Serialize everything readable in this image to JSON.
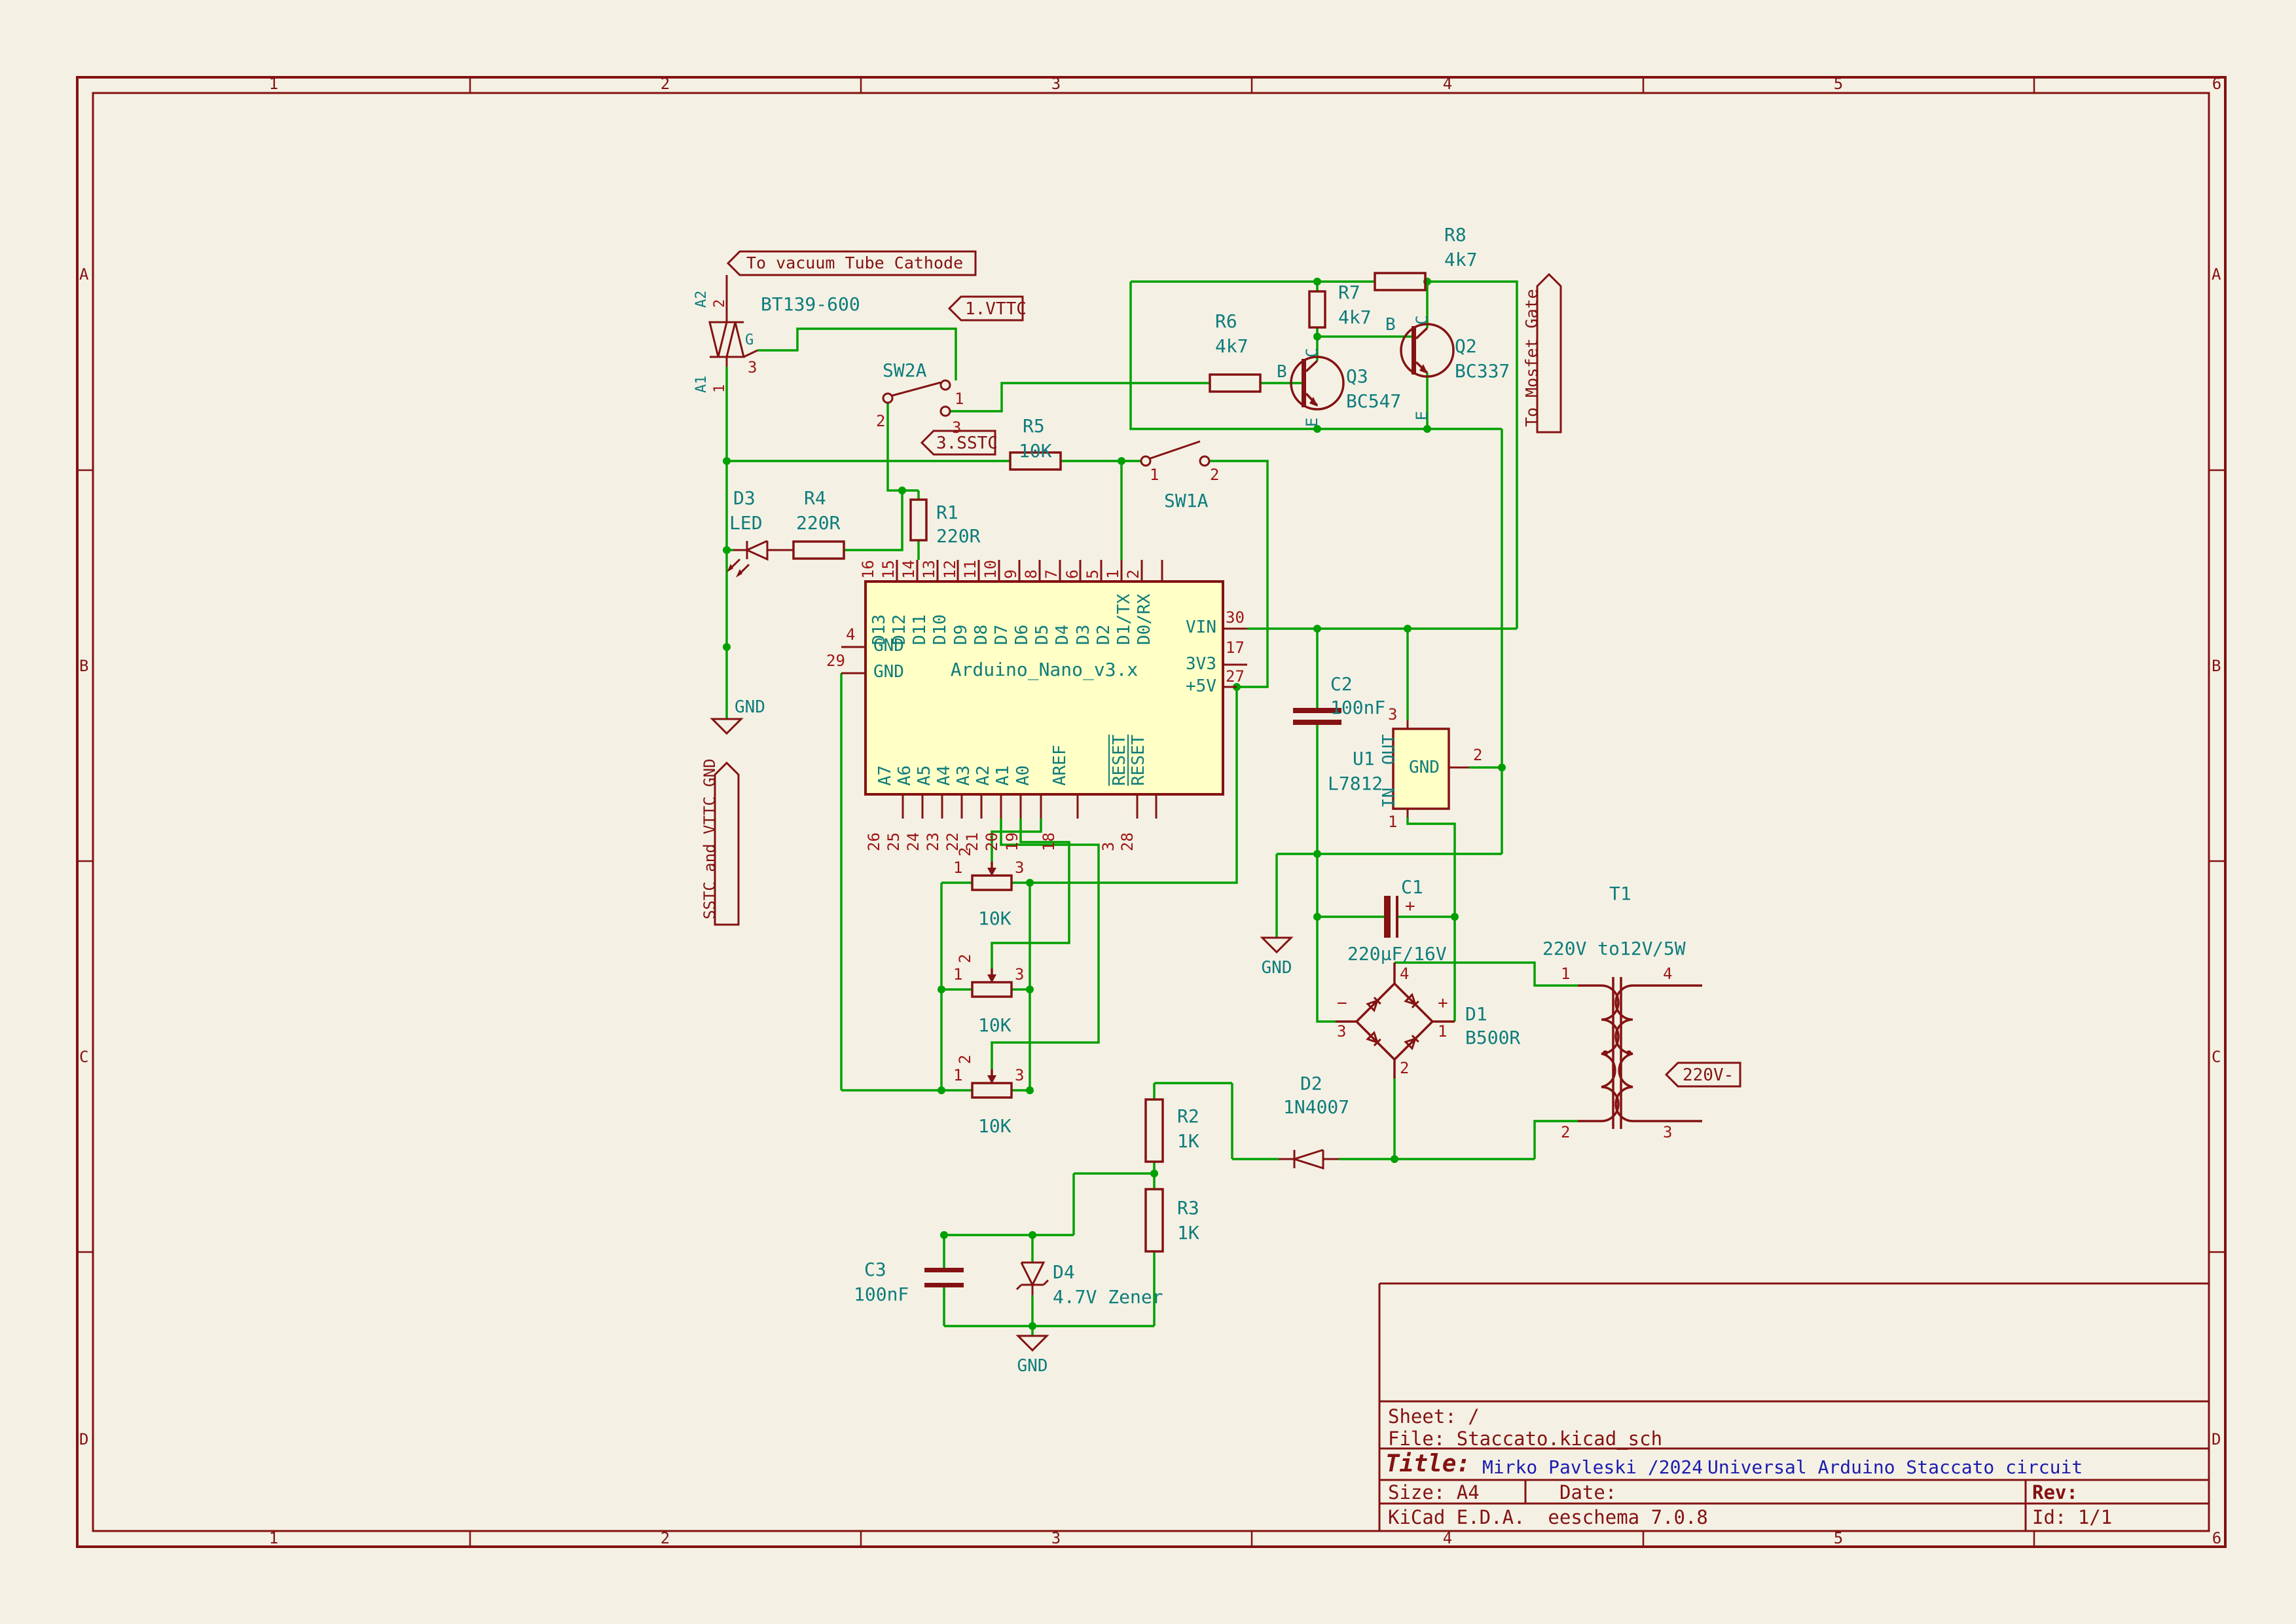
{
  "colors": {
    "background": "#F4F1E4",
    "wire_green": "#00A000",
    "component_red": "#841212",
    "field_teal": "#0E7C7C",
    "pin_number_red": "#9E1515",
    "title_blue": "#1C1CB0",
    "body_yellow": "#FFFFC6"
  },
  "sheet_zones": {
    "columns": [
      "1",
      "2",
      "3",
      "4",
      "5",
      "6"
    ],
    "rows": [
      "A",
      "B",
      "C",
      "D"
    ]
  },
  "title_block": {
    "sheet": "Sheet: /",
    "file": "File: Staccato.kicad_sch",
    "title_label": "Title:",
    "author": "Mirko Pavleski /2024",
    "title": "Universal Arduino Staccato circuit",
    "size": "Size: A4",
    "date": "Date:",
    "rev": "Rev:",
    "software": "KiCad E.D.A.  eeschema 7.0.8",
    "id": "Id: 1/1"
  },
  "hierarchical_labels": {
    "vttc_cathode": "To vacuum Tube Cathode",
    "vttc": "1.VTTC",
    "sstc": "3.SSTC",
    "sstc_vttc_gnd": "SSTC and VTTC GND",
    "mosfet_gate": "To Mosfet Gate",
    "v220": "220V-"
  },
  "power": {
    "gnd": "GND"
  },
  "components": {
    "triac": {
      "value": "BT139-600",
      "pin_a2": "A2",
      "pin_a1": "A1",
      "pin_g": "G",
      "n1": "1",
      "n2": "2",
      "n3": "3"
    },
    "d3": {
      "ref": "D3",
      "value": "LED"
    },
    "r4": {
      "ref": "R4",
      "value": "220R"
    },
    "r1": {
      "ref": "R1",
      "value": "220R"
    },
    "r5": {
      "ref": "R5",
      "value": "10K"
    },
    "sw2a": {
      "ref": "SW2A",
      "n1": "1",
      "n2": "2",
      "n3": "3"
    },
    "sw1a": {
      "ref": "SW1A",
      "n1": "1",
      "n2": "2"
    },
    "r6": {
      "ref": "R6",
      "value": "4k7"
    },
    "r7": {
      "ref": "R7",
      "value": "4k7"
    },
    "r8": {
      "ref": "R8",
      "value": "4k7"
    },
    "q3": {
      "ref": "Q3",
      "value": "BC547",
      "b": "B",
      "c": "C",
      "e": "E"
    },
    "q2": {
      "ref": "Q2",
      "value": "BC337",
      "b": "B",
      "c": "C",
      "e": "E"
    },
    "pot1": {
      "value": "10K",
      "n1": "1",
      "n2": "2",
      "n3": "3"
    },
    "pot2": {
      "value": "10K",
      "n1": "1",
      "n2": "2",
      "n3": "3"
    },
    "pot3": {
      "value": "10K",
      "n1": "1",
      "n2": "2",
      "n3": "3"
    },
    "c2": {
      "ref": "C2",
      "value": "100nF"
    },
    "u1": {
      "ref": "U1",
      "value": "L7812",
      "out": "OUT",
      "gnd": "GND",
      "in": "IN",
      "n1": "1",
      "n2": "2",
      "n3": "3"
    },
    "c1": {
      "ref": "C1",
      "value": "220µF/16V",
      "plus": "+"
    },
    "d1": {
      "ref": "D1",
      "value": "B500R",
      "minus": "−",
      "plus": "+",
      "n1": "1",
      "n2": "2",
      "n3": "3",
      "n4": "4"
    },
    "t1": {
      "ref": "T1",
      "value": "220V to12V",
      "power": "/5W",
      "n1": "1",
      "n2": "2",
      "n3": "3",
      "n4": "4"
    },
    "d2": {
      "ref": "D2",
      "value": "1N4007"
    },
    "r2": {
      "ref": "R2",
      "value": "1K"
    },
    "r3": {
      "ref": "R3",
      "value": "1K"
    },
    "c3": {
      "ref": "C3",
      "value": "100nF"
    },
    "d4": {
      "ref": "D4",
      "value": "4.7V Zener"
    }
  },
  "arduino": {
    "name": "Arduino_Nano_v3.x",
    "top_pins": [
      {
        "n": "16",
        "label": "D13"
      },
      {
        "n": "15",
        "label": "D12"
      },
      {
        "n": "14",
        "label": "D11"
      },
      {
        "n": "13",
        "label": "D10"
      },
      {
        "n": "12",
        "label": "D9"
      },
      {
        "n": "11",
        "label": "D8"
      },
      {
        "n": "10",
        "label": "D7"
      },
      {
        "n": "9",
        "label": "D6"
      },
      {
        "n": "8",
        "label": "D5"
      },
      {
        "n": "7",
        "label": "D4"
      },
      {
        "n": "6",
        "label": "D3"
      },
      {
        "n": "5",
        "label": "D2"
      },
      {
        "n": "1",
        "label": "D1/TX"
      },
      {
        "n": "2",
        "label": "D0/RX"
      }
    ],
    "bottom_pins": [
      {
        "n": "26",
        "label": "A7"
      },
      {
        "n": "25",
        "label": "A6"
      },
      {
        "n": "24",
        "label": "A5"
      },
      {
        "n": "23",
        "label": "A4"
      },
      {
        "n": "22",
        "label": "A3"
      },
      {
        "n": "21",
        "label": "A2"
      },
      {
        "n": "20",
        "label": "A1"
      },
      {
        "n": "19",
        "label": "A0"
      },
      {
        "n": "18",
        "label": "AREF"
      },
      {
        "n": "3",
        "label": "RESET"
      },
      {
        "n": "28",
        "label": "RESET"
      }
    ],
    "left_pins": [
      {
        "n": "4",
        "label": "GND"
      },
      {
        "n": "29",
        "label": "GND"
      }
    ],
    "right_pins": [
      {
        "n": "30",
        "label": "VIN"
      },
      {
        "n": "17",
        "label": "3V3"
      },
      {
        "n": "27",
        "label": "+5V"
      }
    ]
  }
}
